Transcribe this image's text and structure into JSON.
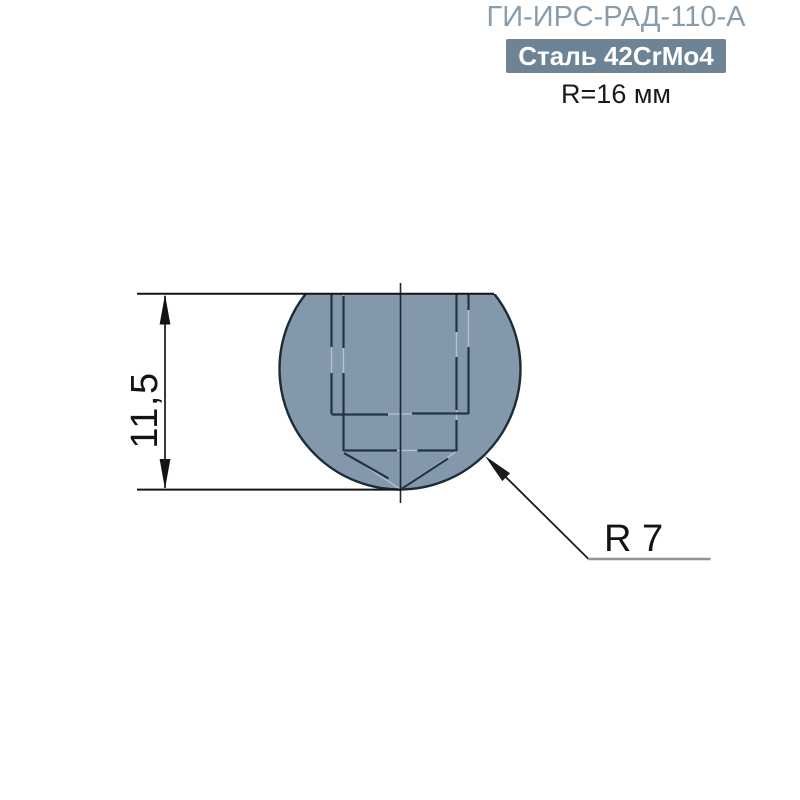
{
  "header": {
    "title": "ГИ-ИРС-РАД-110-А",
    "badge": "Сталь 42CrMo4",
    "radius_note": "R=16 мм"
  },
  "drawing": {
    "height_dimension": "11,5",
    "radius_label": "R 7"
  },
  "colors": {
    "title_color": "#8A9DAC",
    "badge_bg": "#6C8496",
    "badge_text": "#FFFFFF",
    "note_color": "#1A1A1A",
    "part_fill": "#8398AA",
    "part_outline": "#1C2B36",
    "hidden_line": "#223442",
    "hidden_underlay": "#B6C5D1",
    "centerline": "#1B2833",
    "dim_color": "#141414",
    "leader_color": "#1A1A1A",
    "leader_shoulder": "#8E9499"
  }
}
